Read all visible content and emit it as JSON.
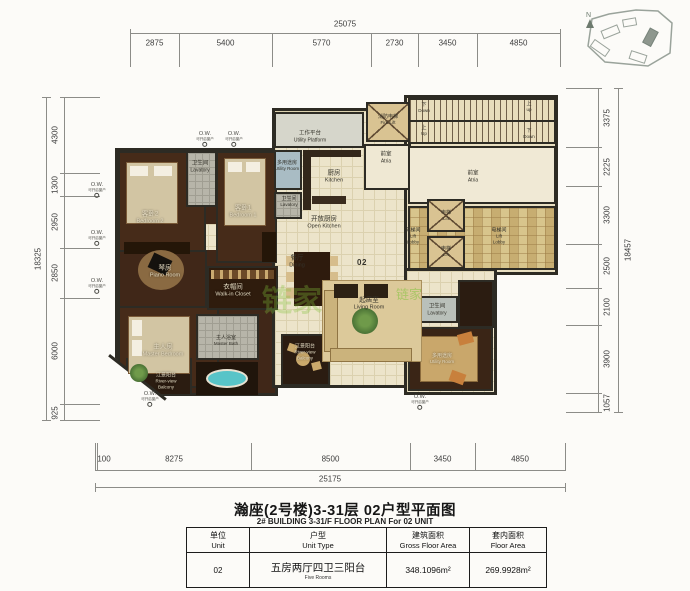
{
  "title": {
    "cn": "瀚座(2号楼)3-31层 02户型平面图",
    "en": "2# BUILDING 3-31/F FLOOR PLAN For 02 UNIT"
  },
  "dimensions": {
    "top": {
      "overall": "25075",
      "segments": [
        "2875",
        "5400",
        "5770",
        "2730",
        "3450",
        "4850"
      ]
    },
    "bottom": {
      "overall": "25175",
      "segments": [
        "100",
        "8275",
        "8500",
        "3450",
        "4850"
      ]
    },
    "left": {
      "overall": "18325",
      "segments": [
        "4300",
        "1300",
        "2950",
        "2850",
        "6000",
        "925"
      ]
    },
    "right": {
      "overall": "18457",
      "segments": [
        "3375",
        "2225",
        "3300",
        "2500",
        "2100",
        "3900",
        "1057"
      ]
    }
  },
  "ow_marker": {
    "abbr": "O.W.",
    "note": "可开启窗户"
  },
  "key_plan": {
    "north": "N"
  },
  "watermark": "链家",
  "rooms": [
    {
      "id": "bedroom2",
      "lines": [
        "客卧2",
        "Bedroom 2"
      ]
    },
    {
      "id": "lav-top",
      "lines": [
        "卫生间",
        "Lavatory"
      ]
    },
    {
      "id": "bedroom1",
      "lines": [
        "客卧1",
        "Bedroom 1"
      ]
    },
    {
      "id": "utility-platform",
      "lines": [
        "工作平台",
        "Utility Platform"
      ]
    },
    {
      "id": "utility-left",
      "lines": [
        "多用途房",
        "Utility Room"
      ]
    },
    {
      "id": "lav-left",
      "lines": [
        "卫生间",
        "Lavatory"
      ]
    },
    {
      "id": "kitchen",
      "lines": [
        "厨房",
        "Kitchen"
      ]
    },
    {
      "id": "open-kitchen",
      "lines": [
        "开放厨房",
        "Open Kitchen"
      ]
    },
    {
      "id": "fire-lift",
      "lines": [
        "消防电梯",
        "Fire Lift"
      ]
    },
    {
      "id": "atria-left",
      "lines": [
        "前室",
        "Atria"
      ]
    },
    {
      "id": "stair-down-a",
      "lines": [
        "下",
        "Down"
      ]
    },
    {
      "id": "stair-up-a",
      "lines": [
        "上",
        "up"
      ]
    },
    {
      "id": "stair-up-b",
      "lines": [
        "上",
        "Up"
      ]
    },
    {
      "id": "stair-down-b",
      "lines": [
        "下",
        "Down"
      ]
    },
    {
      "id": "atria-right",
      "lines": [
        "前室",
        "Atria"
      ]
    },
    {
      "id": "lift-a",
      "lines": [
        "电梯",
        "Lift"
      ]
    },
    {
      "id": "lift-b",
      "lines": [
        "电梯",
        "Lift"
      ]
    },
    {
      "id": "lobby-left",
      "lines": [
        "电梯间",
        "Lift",
        "Lobby"
      ]
    },
    {
      "id": "lobby-right",
      "lines": [
        "电梯间",
        "Lift",
        "Lobby"
      ]
    },
    {
      "id": "dining",
      "lines": [
        "餐厅",
        "Dining"
      ]
    },
    {
      "id": "unit-mark",
      "lines": [
        "02"
      ]
    },
    {
      "id": "living",
      "lines": [
        "起居室",
        "Living Room"
      ]
    },
    {
      "id": "piano",
      "lines": [
        "琴房",
        "Piano Room"
      ]
    },
    {
      "id": "closet",
      "lines": [
        "衣帽间",
        "Walk-in Closet"
      ]
    },
    {
      "id": "master-bath",
      "lines": [
        "主人浴室",
        "Master Bath"
      ]
    },
    {
      "id": "master-bedroom",
      "lines": [
        "主人房",
        "Master Bedroom"
      ]
    },
    {
      "id": "balcony-left",
      "lines": [
        "江景阳台",
        "River-view",
        "Balcony"
      ]
    },
    {
      "id": "balcony-center",
      "lines": [
        "江景阳台",
        "River-view",
        "Balcony"
      ]
    },
    {
      "id": "lav-right",
      "lines": [
        "卫生间",
        "Lavatory"
      ]
    },
    {
      "id": "utility-right",
      "lines": [
        "多用途房",
        "Utility Room"
      ]
    }
  ],
  "table": {
    "headers": [
      {
        "cn": "单位",
        "en": "Unit"
      },
      {
        "cn": "户型",
        "en": "Unit Type"
      },
      {
        "cn": "建筑面积",
        "en": "Gross Floor Area"
      },
      {
        "cn": "套内面积",
        "en": "Floor Area"
      }
    ],
    "row": {
      "unit": "02",
      "type_cn": "五房两厅四卫三阳台",
      "type_en": "Five Rooms",
      "gross_area": "348.1096m²",
      "inner_area": "269.9928m²"
    }
  },
  "colors": {
    "wall": "#2d2b24",
    "wood_floor": "#402718",
    "tile_floor": "#ece4ca",
    "lobby_mosaic": "#d8c58c",
    "bathtub_teal": "#58c4c8",
    "watermark_green": "#82c33c"
  }
}
